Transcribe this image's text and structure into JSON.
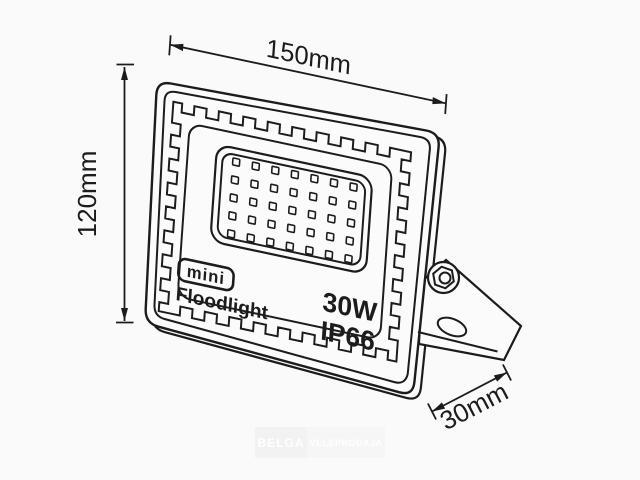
{
  "drawing": {
    "type": "technical-line-drawing",
    "subject": "mini LED floodlight with mounting bracket",
    "labels": {
      "badge": "mini",
      "product": "Floodlight",
      "power": "30W",
      "ip_rating": "IP66"
    },
    "dimensions": {
      "width": "150mm",
      "height": "120mm",
      "depth": "30mm"
    },
    "led_grid": {
      "rows": 5,
      "cols": 7
    },
    "colors": {
      "line": "#1c1c1c",
      "background": "#fafafa",
      "fill": "#fbfbfb"
    },
    "watermark": {
      "left": "BELGA",
      "right": "VELEPRODAJA"
    }
  }
}
